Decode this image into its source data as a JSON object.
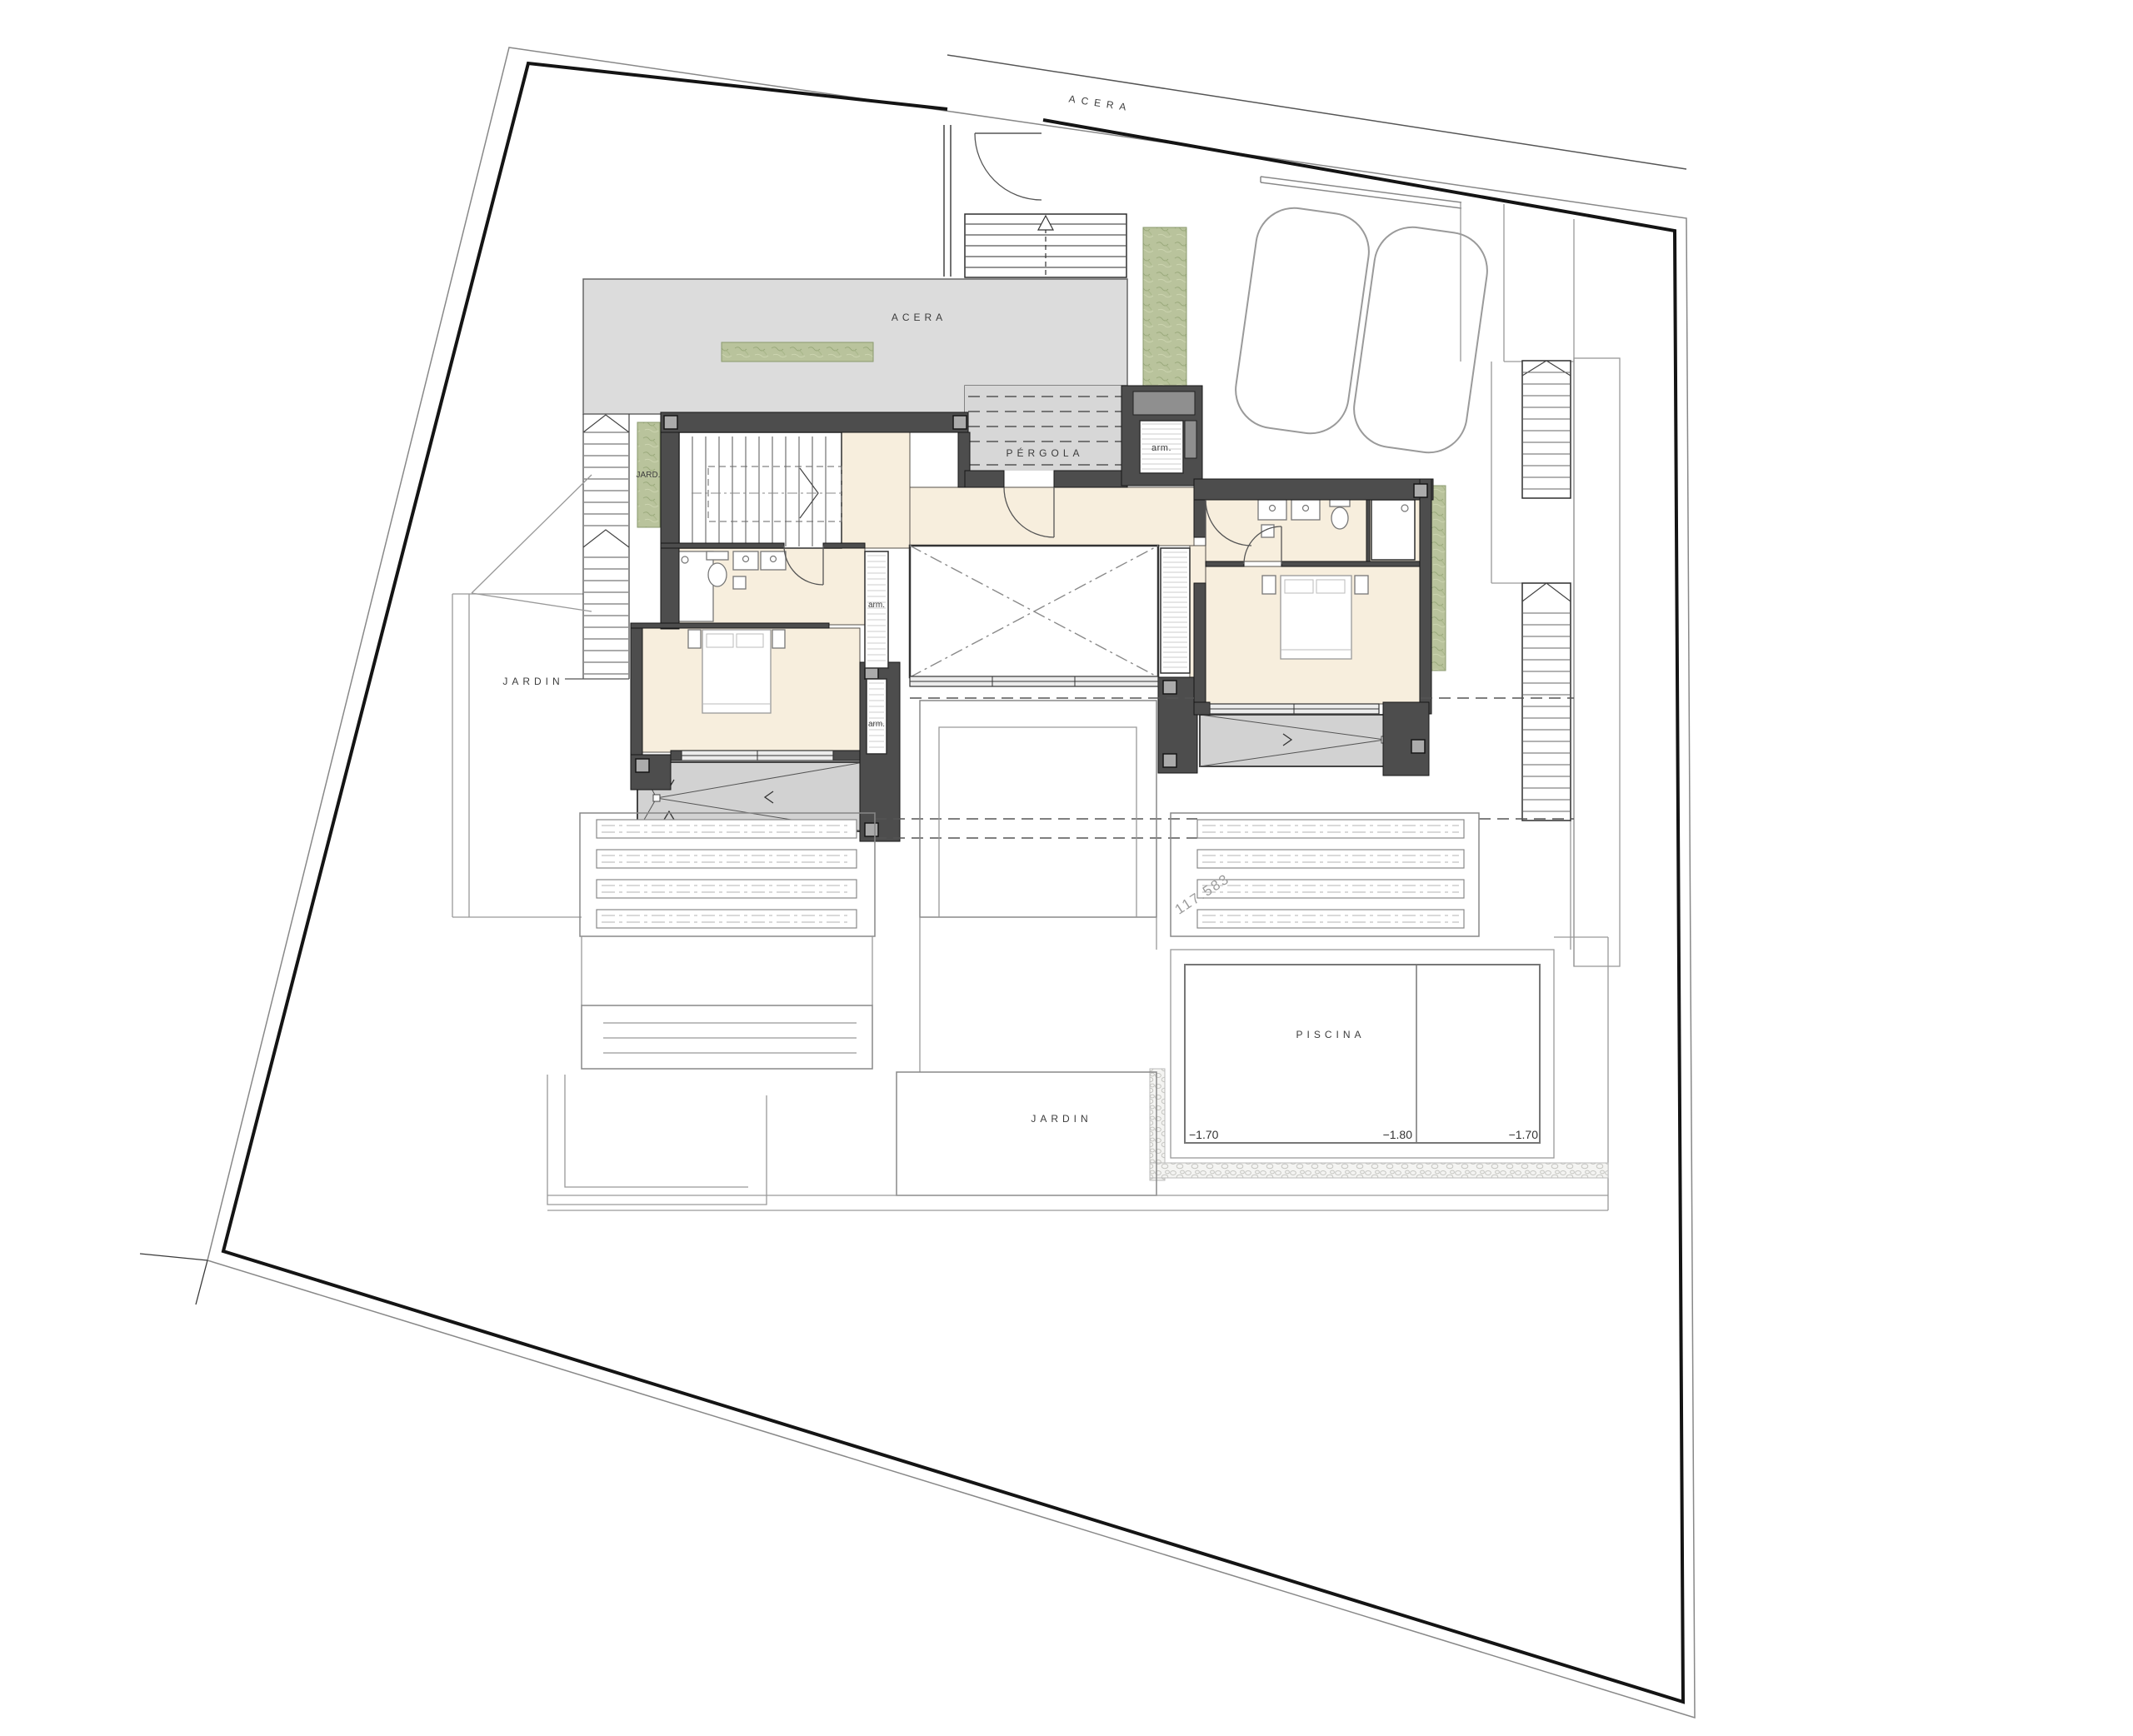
{
  "site": {
    "street_label": "ACERA",
    "terrace_label": "ACERA",
    "pergola_label": "PÉRGOLA",
    "garden_strip_label": "JARD.",
    "garden_west_label": "JARDIN",
    "garden_south_label": "JARDIN",
    "area_annotation": "117.583",
    "pool": {
      "label": "PISCINA",
      "level_left": "−1.70",
      "level_middle": "−1.80",
      "level_right": "−1.70"
    }
  },
  "house": {
    "closet_entry": "arm.",
    "closet_hall": "arm.",
    "closet_bedroom": "arm."
  },
  "colors": {
    "walls": "#4d4d4d",
    "room_floor": "#f7eedd",
    "paving": "#dcdcdc",
    "sloped_terrace": "#d2d2d2",
    "vegetation": "#b9c39c",
    "pool_line": "#777777"
  }
}
